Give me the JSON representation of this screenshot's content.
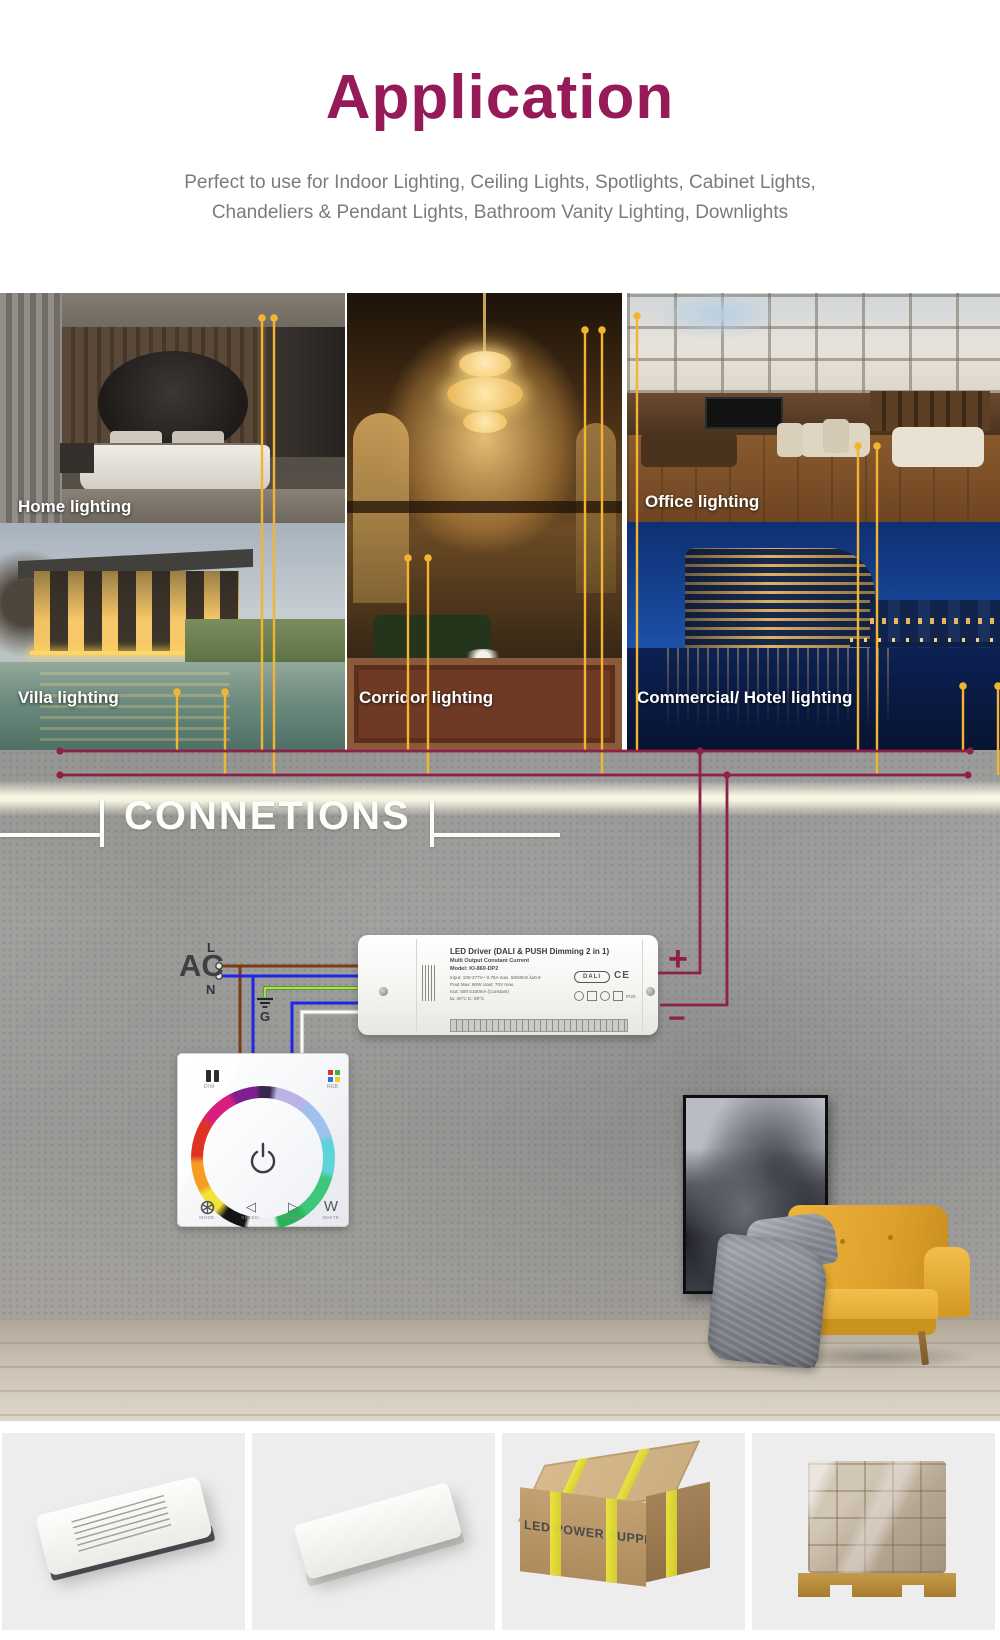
{
  "header": {
    "title": "Application",
    "subtitle_line1": "Perfect to use for Indoor Lighting, Ceiling Lights, Spotlights, Cabinet Lights,",
    "subtitle_line2": "Chandeliers & Pendant Lights, Bathroom Vanity Lighting, Downlights"
  },
  "gallery": {
    "home": "Home lighting",
    "office": "Office lighting",
    "villa": "Villa lighting",
    "corridor": "Corridor lighting",
    "commercial": "Commercial/ Hotel lighting"
  },
  "connections": {
    "heading": "CONNETIONS"
  },
  "diagram": {
    "ac": "AC",
    "live": "L",
    "neutral": "N",
    "ground": "G",
    "plus": "+",
    "minus": "−"
  },
  "driver": {
    "title": "LED Driver (DALI & PUSH Dimming 2 in 1)",
    "subtitle": "Multi Output Constant Current",
    "model": "Model: KI-860-DP2",
    "spec1": "Input: 100-277V~ 0.75A max. 50/60Hz λ≥0.9",
    "spec2": "Pout Max: 60W  Uout: 70V max.",
    "spec3": "Iout: 600-2100mA (Constant)",
    "spec4": "ta: 40°C   tc: 90°C",
    "dali": "DALI",
    "ce": "CE",
    "ip": "IP20"
  },
  "panel": {
    "dim_label": "DIM",
    "rgb_label": "RGB",
    "mode_label": "MODE",
    "speed_minus_label": "SPEED-",
    "speed_plus_label": "SPEED+",
    "white_label": "WHITE",
    "white_symbol": "W",
    "speed_minus_icon": "◁",
    "speed_plus_icon": "▷"
  },
  "packaging": {
    "carton_text": "LED POWER SUPPLY"
  },
  "colors": {
    "accent_magenta": "#951a57",
    "wire_yellow": "#f2b431",
    "wire_maroon": "#8e2148",
    "wire_brown": "#7b3c12",
    "wire_blue": "#2026e8",
    "wire_green": "#2f9e2f",
    "chair_yellow": "#e4a82c"
  }
}
